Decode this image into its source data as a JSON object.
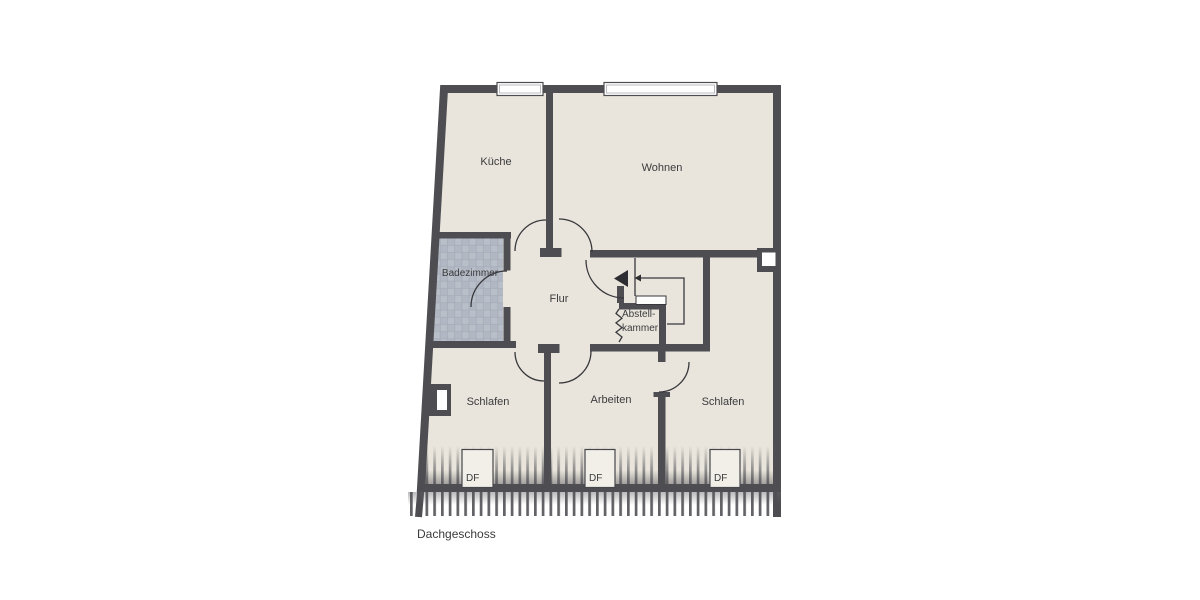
{
  "floor_title": "Dachgeschoss",
  "rooms": {
    "kueche": "Küche",
    "wohnen": "Wohnen",
    "badezimmer": "Badezimmer",
    "flur": "Flur",
    "abstellkammer": {
      "line1": "Abstell-",
      "line2": "kammer"
    },
    "schlafen_left": "Schlafen",
    "arbeiten": "Arbeiten",
    "schlafen_right": "Schlafen"
  },
  "roof_windows": {
    "label": "DF",
    "count": 3
  },
  "colors": {
    "wall": "#4d4d52",
    "floor": "#e9e5dc",
    "bathroom_tile": "#b9bfc9",
    "background": "#ffffff",
    "text": "#3b3b3d",
    "window_fill": "#ffffff"
  }
}
